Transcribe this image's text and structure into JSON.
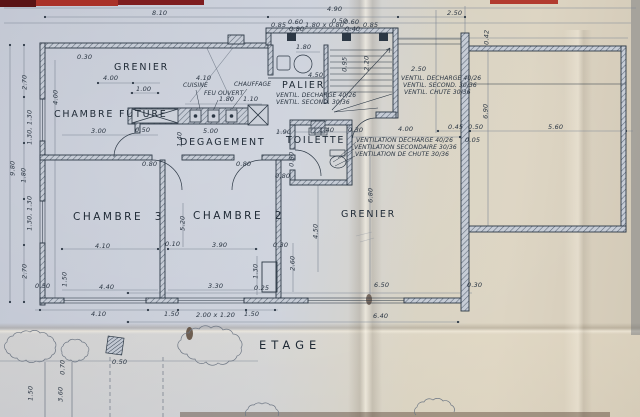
{
  "colors": {
    "paper_blue": "#cbd1db",
    "paper_beige": "#d8cfbd",
    "fold_highlight": "#efe8d8",
    "ink": "#2c3845",
    "pencil": "#7e8795",
    "red_strip_dark": "#5a1315",
    "red_strip_bright": "#a93128"
  },
  "labels": [
    {
      "name": "label-grenier-top",
      "t": "GRENIER",
      "x": 114,
      "y": 63,
      "cls": "room"
    },
    {
      "name": "label-chambre-future",
      "t": "CHAMBRE FUTURE",
      "x": 54,
      "y": 110,
      "cls": "room"
    },
    {
      "name": "label-degagement",
      "t": "DEGAGEMENT",
      "x": 180,
      "y": 138,
      "cls": "room"
    },
    {
      "name": "label-palier",
      "t": "PALIER",
      "x": 282,
      "y": 81,
      "cls": "room"
    },
    {
      "name": "label-toilette",
      "t": "TOILETTE",
      "x": 286,
      "y": 136,
      "cls": "room"
    },
    {
      "name": "label-chambre-3",
      "t": "CHAMBRE  3",
      "x": 73,
      "y": 212,
      "cls": "room-lg"
    },
    {
      "name": "label-chambre-2",
      "t": "CHAMBRE  2",
      "x": 193,
      "y": 211,
      "cls": "room-lg"
    },
    {
      "name": "label-grenier-bottom",
      "t": "GRENIER",
      "x": 341,
      "y": 210,
      "cls": "room"
    },
    {
      "name": "label-etage",
      "t": "ETAGE",
      "x": 259,
      "y": 340,
      "cls": "title"
    },
    {
      "name": "label-cuisine",
      "t": "CUISINE",
      "x": 183,
      "y": 83,
      "cls": "hand"
    },
    {
      "name": "label-feu-ouvert",
      "t": "FEU OUVERT",
      "x": 204,
      "y": 91,
      "cls": "hand"
    },
    {
      "name": "label-chauffage",
      "t": "CHAUFFAGE",
      "x": 234,
      "y": 82,
      "cls": "hand"
    },
    {
      "name": "note-ventil-decharge-palier",
      "t": "VENTIL. DECHARGE 40/26",
      "x": 276,
      "y": 93,
      "cls": "hand"
    },
    {
      "name": "note-ventil-second-palier",
      "t": "VENTIL. SECOND. 30/36",
      "x": 276,
      "y": 100,
      "cls": "hand"
    },
    {
      "name": "note-ventil-decharge",
      "t": "VENTIL. DECHARGE 40/26",
      "x": 401,
      "y": 76,
      "cls": "hand"
    },
    {
      "name": "note-ventil-second",
      "t": "VENTIL. SECOND. 30/36",
      "x": 403,
      "y": 83,
      "cls": "hand"
    },
    {
      "name": "note-ventil-chute",
      "t": "VENTIL. CHUTE 30/36",
      "x": 404,
      "y": 90,
      "cls": "hand"
    },
    {
      "name": "note-ventilation-decharge",
      "t": "VENTILATION DECHARGE 40/26",
      "x": 356,
      "y": 138,
      "cls": "hand"
    },
    {
      "name": "note-ventilation-secondaire",
      "t": "VENTILATION SECONDAIRE 30/36",
      "x": 354,
      "y": 145,
      "cls": "hand"
    },
    {
      "name": "note-ventilation-chute",
      "t": "VENTILATION DE CHUTE 30/36",
      "x": 355,
      "y": 152,
      "cls": "hand"
    },
    {
      "t": "8.10",
      "x": 152,
      "y": 10,
      "cls": "dim"
    },
    {
      "t": "4.90",
      "x": 327,
      "y": 6,
      "cls": "dim"
    },
    {
      "t": "2.50",
      "x": 447,
      "y": 10,
      "cls": "dim"
    },
    {
      "t": "0.85",
      "x": 271,
      "y": 22,
      "cls": "dim"
    },
    {
      "t": "0.60",
      "x": 288,
      "y": 19,
      "cls": "dim"
    },
    {
      "t": "0.80",
      "x": 289,
      "y": 26,
      "cls": "dim"
    },
    {
      "t": "1.80 x 0.80",
      "x": 305,
      "y": 22,
      "cls": "dim"
    },
    {
      "t": "0.50",
      "x": 332,
      "y": 18,
      "cls": "dim"
    },
    {
      "t": "0.60",
      "x": 344,
      "y": 19,
      "cls": "dim"
    },
    {
      "t": "0.40",
      "x": 345,
      "y": 26,
      "cls": "dim"
    },
    {
      "t": "0.85",
      "x": 363,
      "y": 22,
      "cls": "dim"
    },
    {
      "t": "4.00",
      "x": 103,
      "y": 75,
      "cls": "dim"
    },
    {
      "t": "1.00",
      "x": 136,
      "y": 86,
      "cls": "dim"
    },
    {
      "t": "3.00",
      "x": 91,
      "y": 128,
      "cls": "dim"
    },
    {
      "t": "0.50",
      "x": 135,
      "y": 127,
      "cls": "dim"
    },
    {
      "t": "4.10",
      "x": 196,
      "y": 75,
      "cls": "dim"
    },
    {
      "t": "1.80",
      "x": 219,
      "y": 96,
      "cls": "dim"
    },
    {
      "t": "1.10",
      "x": 243,
      "y": 96,
      "cls": "dim"
    },
    {
      "t": "5.00",
      "x": 203,
      "y": 128,
      "cls": "dim"
    },
    {
      "t": "1.80",
      "x": 296,
      "y": 44,
      "cls": "dim"
    },
    {
      "t": "4.50",
      "x": 308,
      "y": 72,
      "cls": "dim"
    },
    {
      "t": "2.50",
      "x": 411,
      "y": 66,
      "cls": "dim"
    },
    {
      "t": "1.90",
      "x": 276,
      "y": 129,
      "cls": "dim"
    },
    {
      "t": "1.40",
      "x": 319,
      "y": 127,
      "cls": "dim"
    },
    {
      "t": "0.30",
      "x": 348,
      "y": 127,
      "cls": "dim"
    },
    {
      "t": "0.80",
      "x": 275,
      "y": 173,
      "cls": "dim"
    },
    {
      "t": "0.80",
      "x": 142,
      "y": 161,
      "cls": "dim"
    },
    {
      "t": "0.80",
      "x": 236,
      "y": 161,
      "cls": "dim"
    },
    {
      "t": "4.00",
      "x": 398,
      "y": 126,
      "cls": "dim"
    },
    {
      "t": "0.45",
      "x": 448,
      "y": 124,
      "cls": "dim"
    },
    {
      "t": "0.50",
      "x": 468,
      "y": 124,
      "cls": "dim"
    },
    {
      "t": "5.60",
      "x": 548,
      "y": 124,
      "cls": "dim"
    },
    {
      "t": "0.05",
      "x": 465,
      "y": 137,
      "cls": "dim"
    },
    {
      "t": "0.30",
      "x": 77,
      "y": 54,
      "cls": "dim"
    },
    {
      "t": "0.10",
      "x": 165,
      "y": 241,
      "cls": "dim"
    },
    {
      "t": "0.30",
      "x": 273,
      "y": 242,
      "cls": "dim"
    },
    {
      "t": "4.10",
      "x": 95,
      "y": 243,
      "cls": "dim"
    },
    {
      "t": "3.90",
      "x": 212,
      "y": 242,
      "cls": "dim"
    },
    {
      "t": "4.40",
      "x": 99,
      "y": 284,
      "cls": "dim"
    },
    {
      "t": "3.30",
      "x": 208,
      "y": 283,
      "cls": "dim"
    },
    {
      "t": "0.50",
      "x": 35,
      "y": 283,
      "cls": "dim"
    },
    {
      "t": "0.25",
      "x": 254,
      "y": 285,
      "cls": "dim"
    },
    {
      "t": "4.10",
      "x": 91,
      "y": 311,
      "cls": "dim"
    },
    {
      "t": "1.50",
      "x": 164,
      "y": 311,
      "cls": "dim"
    },
    {
      "t": "2.00 x 1.20",
      "x": 196,
      "y": 312,
      "cls": "dim"
    },
    {
      "t": "1.50",
      "x": 244,
      "y": 311,
      "cls": "dim"
    },
    {
      "t": "6.50",
      "x": 374,
      "y": 282,
      "cls": "dim"
    },
    {
      "t": "0.30",
      "x": 467,
      "y": 282,
      "cls": "dim"
    },
    {
      "t": "6.40",
      "x": 373,
      "y": 313,
      "cls": "dim"
    },
    {
      "t": "0.50",
      "x": 112,
      "y": 359,
      "cls": "dim"
    },
    {
      "t": "2.70",
      "x": 17,
      "y": 79,
      "r": -90,
      "cls": "dim"
    },
    {
      "t": "4.00",
      "x": 48,
      "y": 94,
      "r": -90,
      "cls": "dim"
    },
    {
      "t": "1.30, 1.30",
      "x": 12,
      "y": 124,
      "r": -90,
      "cls": "dim"
    },
    {
      "t": "9.80",
      "x": 5,
      "y": 165,
      "r": -90,
      "cls": "dim"
    },
    {
      "t": "1.80",
      "x": 16,
      "y": 172,
      "r": -90,
      "cls": "dim"
    },
    {
      "t": "1.30, 1.30",
      "x": 12,
      "y": 210,
      "r": -90,
      "cls": "dim"
    },
    {
      "t": "2.70",
      "x": 17,
      "y": 268,
      "r": -90,
      "cls": "dim"
    },
    {
      "t": "1.50",
      "x": 57,
      "y": 276,
      "r": -90,
      "cls": "dim"
    },
    {
      "t": "1.40",
      "x": 172,
      "y": 136,
      "r": -90,
      "cls": "dim"
    },
    {
      "t": "2.20",
      "x": 359,
      "y": 60,
      "r": -90,
      "cls": "dim"
    },
    {
      "t": "0.95",
      "x": 337,
      "y": 61,
      "r": -90,
      "cls": "dim"
    },
    {
      "t": "5.20",
      "x": 175,
      "y": 220,
      "r": -90,
      "cls": "dim"
    },
    {
      "t": "4.50",
      "x": 308,
      "y": 228,
      "r": -90,
      "cls": "dim"
    },
    {
      "t": "2.60",
      "x": 285,
      "y": 260,
      "r": -90,
      "cls": "dim"
    },
    {
      "t": "1.30",
      "x": 248,
      "y": 268,
      "r": -90,
      "cls": "dim"
    },
    {
      "t": "6.80",
      "x": 363,
      "y": 192,
      "r": -90,
      "cls": "dim"
    },
    {
      "t": "6.90",
      "x": 478,
      "y": 108,
      "r": -90,
      "cls": "dim"
    },
    {
      "t": "0.42",
      "x": 479,
      "y": 34,
      "r": -90,
      "cls": "dim"
    },
    {
      "t": "0.80",
      "x": 284,
      "y": 156,
      "r": -90,
      "cls": "dim"
    },
    {
      "t": "0.70",
      "x": 55,
      "y": 364,
      "r": -90,
      "cls": "dim"
    },
    {
      "t": "1.50",
      "x": 23,
      "y": 390,
      "r": -90,
      "cls": "dim"
    },
    {
      "t": "3.60",
      "x": 53,
      "y": 391,
      "r": -90,
      "cls": "dim"
    }
  ]
}
